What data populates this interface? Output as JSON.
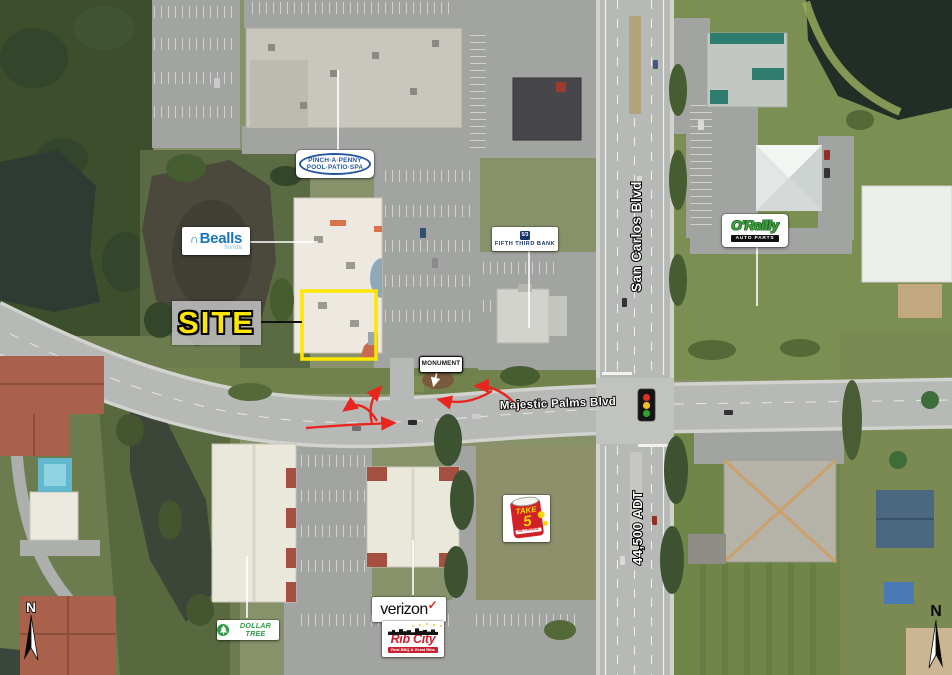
{
  "map": {
    "callouts": {
      "pinch_a_penny": {
        "line1": "PINCH·A·PENNY",
        "line2": "POOL·PATIO·SPA"
      },
      "bealls": {
        "mark": "∩",
        "name": "Bealls",
        "sub": "florida"
      },
      "site": {
        "label": "SITE"
      },
      "fifth_third_bank": {
        "logo": "5/3",
        "name": "FIFTH THIRD BANK"
      },
      "oreilly": {
        "name": "O'Reilly",
        "sub": "AUTO PARTS"
      },
      "monument": {
        "label": "MONUMENT"
      },
      "take_5": {
        "line1": "TAKE",
        "line2": "5",
        "sub": "OIL CHANGE"
      },
      "verizon": {
        "name": "verizon",
        "check": "✓"
      },
      "rib_city": {
        "name": "Rib City",
        "sub": "Real BBQ & Great Ribs"
      },
      "dollar_tree": {
        "name": "DOLLAR TREE"
      }
    },
    "roads": {
      "san_carlos": "San Carlos Blvd",
      "majestic_palms": "Majestic Palms Blvd",
      "traffic_count": "44,500 ADT"
    },
    "compass": {
      "north_left": "N",
      "north_right": "N"
    },
    "colors": {
      "site_outline": "#ffe600",
      "turn_arrows": "#e8251f"
    }
  }
}
